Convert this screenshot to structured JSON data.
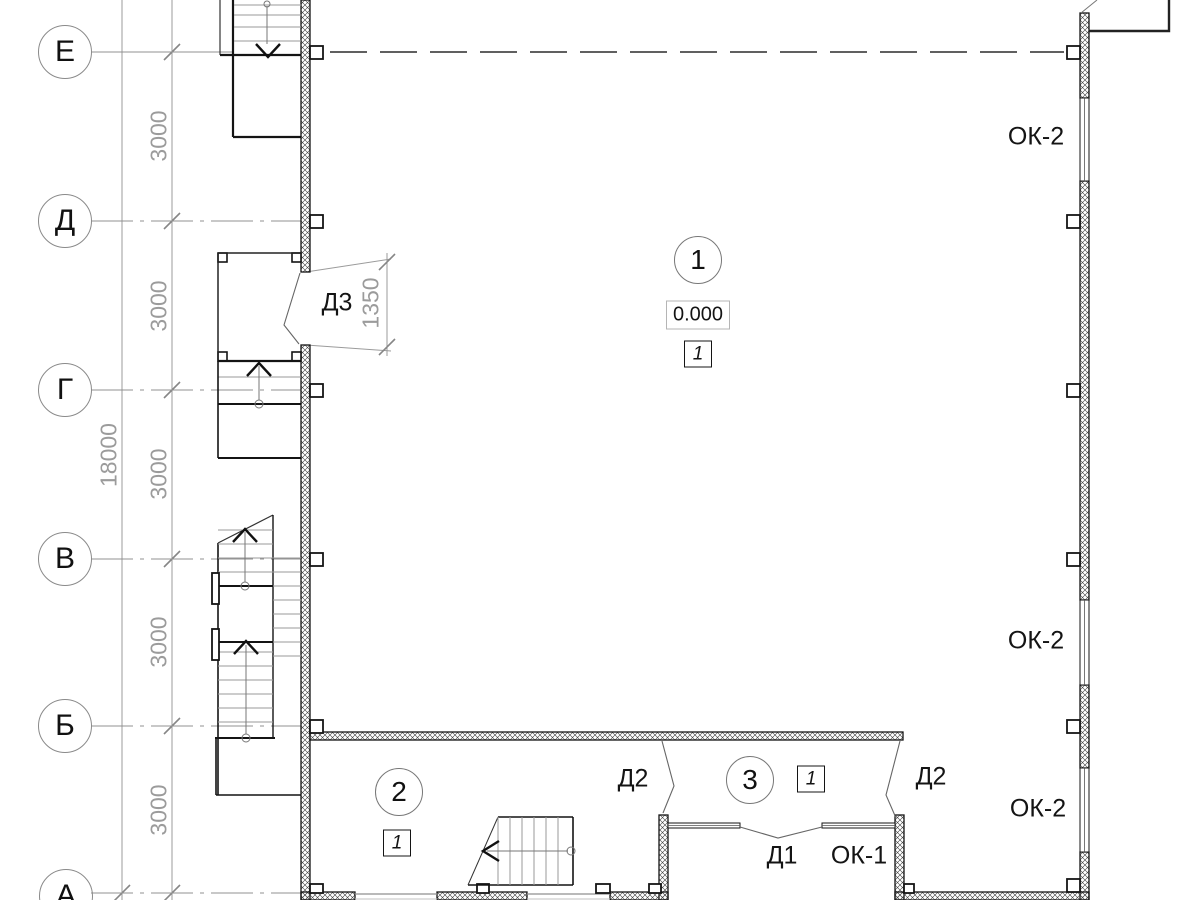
{
  "axes": {
    "items": [
      {
        "label": "Е"
      },
      {
        "label": "Д"
      },
      {
        "label": "Г"
      },
      {
        "label": "В"
      },
      {
        "label": "Б"
      },
      {
        "label": "А"
      }
    ]
  },
  "dimensions": {
    "total_height": "18000",
    "bays": [
      "3000",
      "3000",
      "3000",
      "3000",
      "3000"
    ],
    "door_offset": "1350"
  },
  "rooms": {
    "hall": {
      "number": "1",
      "elevation": "0.000",
      "floor_mark": "1"
    },
    "room2": {
      "number": "2",
      "floor_mark": "1"
    },
    "vestibule": {
      "number": "3",
      "floor_mark": "1"
    }
  },
  "doors": {
    "d3": "Д3",
    "d2_left": "Д2",
    "d2_right": "Д2",
    "d1": "Д1"
  },
  "windows": {
    "ok2_top": "ОК-2",
    "ok2_mid": "ОК-2",
    "ok2_bottom": "ОК-2",
    "ok1": "ОК-1"
  },
  "colors": {
    "line": "#141414",
    "dimension_gray": "#9b9b9b",
    "hatch": "#3d3d3d",
    "background": "#ffffff"
  }
}
